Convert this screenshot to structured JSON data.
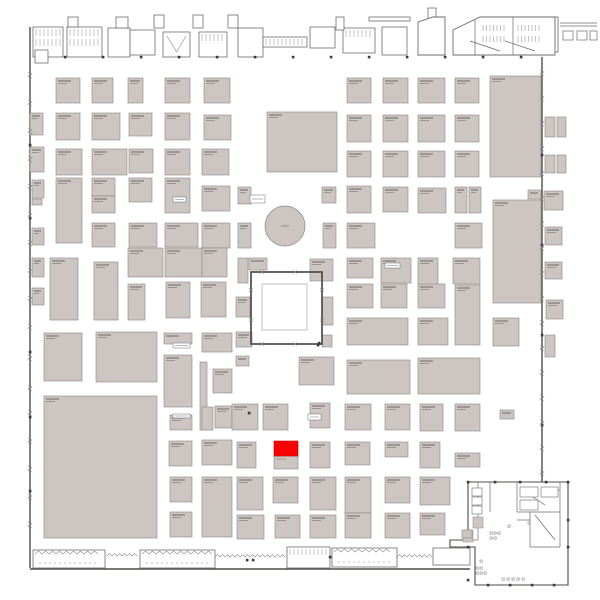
{
  "meta": {
    "title": "Exhibition hall floor plan",
    "canvas": {
      "w": 600,
      "h": 600,
      "bg": "#ffffff"
    }
  },
  "palette": {
    "booth_fill": "#ccc5c2",
    "booth_stroke": "#8d8682",
    "label_dark": "#564f4b",
    "label_light": "#7a736e",
    "wall": "#4f4a46",
    "structure": "#6b6b6b",
    "detail": "#888888",
    "column": "#3a3a3a",
    "highlight": "#fa0000",
    "courtyard_wall": "#4f4a46",
    "inner_square": "#9a9a9a",
    "white": "#ffffff"
  },
  "selected_booth": {
    "x": 274,
    "y": 441,
    "w": 24,
    "h": 15,
    "color": "#fa0000"
  },
  "selected_booth_base": {
    "x": 274,
    "y": 456,
    "w": 24,
    "h": 13
  },
  "circle": {
    "cx": 285,
    "cy": 226,
    "r": 20
  },
  "courtyard": {
    "outer": [
      251,
      272,
      71,
      72
    ],
    "inner": [
      262,
      284,
      45,
      46
    ]
  },
  "booths": [
    [
      56,
      78,
      24,
      25
    ],
    [
      92,
      78,
      21,
      25
    ],
    [
      128,
      78,
      15,
      25
    ],
    [
      165,
      78,
      25,
      25
    ],
    [
      204,
      78,
      26,
      25
    ],
    [
      30,
      113,
      13,
      22
    ],
    [
      56,
      113,
      24,
      27
    ],
    [
      92,
      113,
      28,
      27
    ],
    [
      129,
      113,
      23,
      23
    ],
    [
      165,
      113,
      25,
      27
    ],
    [
      204,
      115,
      27,
      25
    ],
    [
      30,
      147,
      14,
      25
    ],
    [
      56,
      149,
      26,
      26
    ],
    [
      92,
      149,
      35,
      26
    ],
    [
      129,
      149,
      24,
      24
    ],
    [
      165,
      149,
      25,
      26
    ],
    [
      202,
      149,
      27,
      26
    ],
    [
      32,
      180,
      12,
      18
    ],
    [
      32,
      199,
      10,
      6
    ],
    [
      56,
      178,
      26,
      65
    ],
    [
      92,
      178,
      23,
      18
    ],
    [
      92,
      196,
      23,
      17
    ],
    [
      129,
      178,
      23,
      24
    ],
    [
      165,
      178,
      25,
      35
    ],
    [
      202,
      186,
      28,
      25
    ],
    [
      32,
      228,
      12,
      17
    ],
    [
      92,
      223,
      23,
      24
    ],
    [
      129,
      223,
      28,
      24
    ],
    [
      165,
      223,
      33,
      24
    ],
    [
      202,
      223,
      28,
      25
    ],
    [
      32,
      258,
      12,
      19
    ],
    [
      32,
      288,
      12,
      17
    ],
    [
      50,
      258,
      28,
      62
    ],
    [
      94,
      262,
      24,
      58
    ],
    [
      128,
      248,
      35,
      29
    ],
    [
      165,
      248,
      37,
      29
    ],
    [
      202,
      248,
      25,
      29
    ],
    [
      128,
      284,
      17,
      36
    ],
    [
      166,
      282,
      24,
      36
    ],
    [
      201,
      282,
      25,
      35
    ],
    [
      267,
      112,
      70,
      60
    ],
    [
      238,
      187,
      13,
      17
    ],
    [
      238,
      223,
      13,
      25
    ],
    [
      322,
      187,
      14,
      16
    ],
    [
      323,
      223,
      13,
      25
    ],
    [
      347,
      186,
      24,
      27
    ],
    [
      347,
      223,
      28,
      25
    ],
    [
      347,
      78,
      24,
      25
    ],
    [
      383,
      78,
      25,
      25
    ],
    [
      418,
      78,
      27,
      25
    ],
    [
      455,
      78,
      24,
      25
    ],
    [
      490,
      76,
      51,
      101
    ],
    [
      347,
      115,
      24,
      27
    ],
    [
      383,
      115,
      25,
      27
    ],
    [
      418,
      115,
      27,
      27
    ],
    [
      455,
      115,
      24,
      27
    ],
    [
      347,
      151,
      24,
      26
    ],
    [
      383,
      151,
      25,
      26
    ],
    [
      418,
      151,
      27,
      26
    ],
    [
      455,
      151,
      24,
      26
    ],
    [
      383,
      187,
      25,
      25
    ],
    [
      418,
      188,
      28,
      25
    ],
    [
      455,
      187,
      12,
      26
    ],
    [
      469,
      187,
      12,
      26
    ],
    [
      528,
      190,
      13,
      9
    ],
    [
      455,
      223,
      27,
      25
    ],
    [
      493,
      200,
      48,
      103
    ],
    [
      347,
      258,
      26,
      20
    ],
    [
      381,
      258,
      30,
      25
    ],
    [
      418,
      258,
      20,
      27
    ],
    [
      453,
      258,
      27,
      26
    ],
    [
      347,
      284,
      26,
      24
    ],
    [
      381,
      284,
      26,
      24
    ],
    [
      418,
      284,
      27,
      24
    ],
    [
      455,
      285,
      25,
      60
    ],
    [
      545,
      117,
      10,
      20
    ],
    [
      557,
      117,
      9,
      20
    ],
    [
      545,
      155,
      10,
      18
    ],
    [
      557,
      155,
      9,
      18
    ],
    [
      544,
      191,
      19,
      19
    ],
    [
      545,
      227,
      17,
      18
    ],
    [
      545,
      262,
      17,
      17
    ],
    [
      546,
      300,
      17,
      19
    ],
    [
      545,
      335,
      10,
      22
    ],
    [
      238,
      258,
      10,
      25
    ],
    [
      249,
      258,
      18,
      12
    ],
    [
      310,
      259,
      23,
      22
    ],
    [
      236,
      297,
      14,
      20
    ],
    [
      236,
      332,
      16,
      15
    ],
    [
      322,
      297,
      11,
      28
    ],
    [
      322,
      335,
      10,
      12
    ],
    [
      236,
      356,
      13,
      10
    ],
    [
      299,
      357,
      35,
      28
    ],
    [
      347,
      318,
      61,
      27
    ],
    [
      418,
      318,
      30,
      27
    ],
    [
      493,
      318,
      26,
      28
    ],
    [
      347,
      360,
      63,
      34
    ],
    [
      418,
      358,
      62,
      36
    ],
    [
      44,
      333,
      38,
      48
    ],
    [
      96,
      332,
      61,
      50
    ],
    [
      44,
      396,
      113,
      142
    ],
    [
      164,
      333,
      28,
      11
    ],
    [
      202,
      333,
      30,
      19
    ],
    [
      164,
      355,
      28,
      52
    ],
    [
      200,
      362,
      7,
      68
    ],
    [
      213,
      369,
      19,
      24
    ],
    [
      202,
      407,
      11,
      23
    ],
    [
      215,
      406,
      17,
      22
    ],
    [
      170,
      415,
      22,
      15
    ],
    [
      169,
      441,
      23,
      25
    ],
    [
      202,
      440,
      30,
      25
    ],
    [
      170,
      477,
      22,
      25
    ],
    [
      202,
      477,
      30,
      60
    ],
    [
      170,
      512,
      22,
      25
    ],
    [
      232,
      404,
      26,
      26
    ],
    [
      263,
      404,
      25,
      26
    ],
    [
      237,
      442,
      19,
      26
    ],
    [
      237,
      477,
      26,
      33
    ],
    [
      273,
      477,
      25,
      26
    ],
    [
      237,
      515,
      27,
      24
    ],
    [
      275,
      515,
      25,
      23
    ],
    [
      310,
      403,
      20,
      25
    ],
    [
      345,
      404,
      26,
      26
    ],
    [
      385,
      404,
      25,
      26
    ],
    [
      420,
      404,
      23,
      27
    ],
    [
      455,
      404,
      25,
      27
    ],
    [
      500,
      410,
      14,
      9
    ],
    [
      310,
      442,
      20,
      26
    ],
    [
      345,
      442,
      25,
      23
    ],
    [
      385,
      442,
      23,
      15
    ],
    [
      420,
      442,
      20,
      26
    ],
    [
      455,
      453,
      25,
      14
    ],
    [
      310,
      477,
      26,
      33
    ],
    [
      345,
      477,
      26,
      36
    ],
    [
      385,
      477,
      25,
      26
    ],
    [
      420,
      477,
      30,
      28
    ],
    [
      310,
      515,
      26,
      23
    ],
    [
      345,
      513,
      26,
      25
    ],
    [
      385,
      513,
      25,
      25
    ],
    [
      420,
      513,
      25,
      22
    ],
    [
      462,
      530,
      10,
      8
    ]
  ],
  "label_boxes": [
    [
      250,
      195,
      15,
      8
    ],
    [
      173,
      343,
      17,
      5
    ],
    [
      308,
      414,
      13,
      6
    ],
    [
      173,
      414,
      17,
      4
    ],
    [
      385,
      263,
      15,
      5
    ],
    [
      173,
      197,
      13,
      5
    ]
  ],
  "rooms": [
    {
      "r": [
        33,
        27,
        30,
        30
      ],
      "d": "stalls2"
    },
    {
      "r": [
        35,
        50,
        13,
        13
      ],
      "d": "plain"
    },
    {
      "r": [
        67,
        27,
        35,
        30
      ],
      "d": "stalls2"
    },
    {
      "r": [
        108,
        28,
        22,
        29
      ],
      "d": "plain"
    },
    {
      "r": [
        130,
        30,
        25,
        25
      ],
      "d": "plain"
    },
    {
      "r": [
        163,
        32,
        27,
        25
      ],
      "d": "vee"
    },
    {
      "r": [
        199,
        32,
        28,
        25
      ],
      "d": "stalls"
    },
    {
      "r": [
        238,
        28,
        25,
        29
      ],
      "d": "plain"
    },
    {
      "r": [
        263,
        37,
        44,
        10
      ],
      "d": "comb"
    },
    {
      "r": [
        310,
        27,
        25,
        21
      ],
      "d": "plain"
    },
    {
      "r": [
        343,
        28,
        32,
        25
      ],
      "d": "stalls"
    },
    {
      "r": [
        382,
        27,
        25,
        28
      ],
      "d": "plain"
    }
  ],
  "towers": [
    [
      68,
      17,
      10,
      10
    ],
    [
      116,
      17,
      12,
      11
    ],
    [
      154,
      15,
      10,
      13
    ],
    [
      193,
      15,
      10,
      13
    ],
    [
      228,
      15,
      10,
      13
    ],
    [
      336,
      17,
      8,
      13
    ],
    [
      428,
      8,
      8,
      12
    ]
  ],
  "bars": [
    [
      369,
      17,
      41,
      4
    ],
    [
      552,
      17,
      6,
      35
    ]
  ],
  "trapezoid": [
    [
      418,
      55
    ],
    [
      418,
      22
    ],
    [
      433,
      17
    ],
    [
      445,
      17
    ],
    [
      445,
      55
    ]
  ],
  "top_complex": {
    "poly": [
      [
        453,
        55
      ],
      [
        453,
        30
      ],
      [
        480,
        17
      ],
      [
        555,
        17
      ],
      [
        555,
        55
      ]
    ],
    "combs": [
      [
        483,
        25,
        24
      ],
      [
        518,
        25,
        22
      ],
      [
        483,
        36,
        24
      ],
      [
        518,
        36,
        22
      ]
    ],
    "lines": [
      [
        475,
        20,
        475,
        55
      ],
      [
        513,
        17,
        513,
        55
      ],
      [
        470,
        41,
        500,
        51
      ],
      [
        505,
        41,
        535,
        51
      ],
      [
        453,
        55,
        555,
        55
      ]
    ]
  },
  "canopy": {
    "lines": [
      [
        560,
        23,
        597,
        23
      ],
      [
        560,
        26,
        597,
        26
      ]
    ],
    "boxes": [
      [
        563,
        31,
        10,
        9
      ],
      [
        577,
        31,
        10,
        9
      ],
      [
        590,
        31,
        7,
        9
      ]
    ]
  },
  "bottom_rooms": [
    {
      "r": [
        33,
        550,
        72,
        18
      ],
      "d": "saw"
    },
    {
      "r": [
        140,
        550,
        75,
        18
      ],
      "d": "saw"
    },
    {
      "r": [
        287,
        547,
        43,
        21
      ],
      "d": "comb"
    },
    {
      "r": [
        332,
        548,
        65,
        19
      ],
      "d": "saw"
    },
    {
      "r": [
        433,
        548,
        37,
        17
      ],
      "d": "plain"
    }
  ],
  "zigzag_walls": [
    [
      107,
      556,
      140,
      556
    ],
    [
      215,
      557,
      287,
      557
    ],
    [
      397,
      557,
      433,
      557
    ]
  ],
  "walls": [
    [
      30,
      27,
      30,
      568
    ],
    [
      542,
      57,
      542,
      482
    ],
    [
      30,
      569,
      470,
      569
    ]
  ],
  "entrance": {
    "outline": [
      [
        468,
        482
      ],
      [
        568,
        482
      ],
      [
        568,
        585
      ],
      [
        475,
        585
      ],
      [
        475,
        547
      ],
      [
        450,
        547
      ],
      [
        450,
        540
      ],
      [
        468,
        540
      ],
      [
        468,
        482
      ]
    ],
    "lines": [
      [
        478,
        482,
        478,
        540
      ],
      [
        468,
        540,
        478,
        540
      ],
      [
        517,
        482,
        517,
        512
      ],
      [
        517,
        512,
        560,
        512
      ],
      [
        560,
        482,
        560,
        512
      ],
      [
        530,
        512,
        530,
        547
      ],
      [
        530,
        547,
        560,
        547
      ],
      [
        560,
        512,
        560,
        547
      ],
      [
        517,
        520,
        530,
        520
      ],
      [
        535,
        515,
        555,
        540
      ],
      [
        490,
        482,
        490,
        512
      ],
      [
        545,
        490,
        560,
        490
      ],
      [
        530,
        495,
        545,
        505
      ]
    ],
    "rooms": [
      [
        472,
        488,
        10,
        8
      ],
      [
        472,
        497,
        10,
        8
      ],
      [
        472,
        506,
        10,
        8
      ],
      [
        520,
        487,
        18,
        10
      ],
      [
        541,
        487,
        17,
        10
      ],
      [
        520,
        500,
        18,
        10
      ]
    ],
    "gray": [
      [
        463,
        530,
        10,
        12
      ],
      [
        473,
        517,
        10,
        11
      ]
    ],
    "dots": [
      [
        490,
        532
      ],
      [
        494,
        532
      ],
      [
        498,
        532
      ],
      [
        490,
        537
      ],
      [
        494,
        537
      ],
      [
        476,
        567
      ],
      [
        480,
        567
      ],
      [
        476,
        572
      ],
      [
        480,
        572
      ],
      [
        484,
        572
      ],
      [
        502,
        578
      ],
      [
        507,
        578
      ],
      [
        512,
        578
      ],
      [
        517,
        578
      ],
      [
        522,
        578
      ],
      [
        480,
        560
      ],
      [
        528,
        522
      ],
      [
        508,
        525
      ]
    ]
  },
  "columns": [
    [
      65,
      57
    ],
    [
      103,
      57
    ],
    [
      141,
      57
    ],
    [
      179,
      57
    ],
    [
      217,
      57
    ],
    [
      255,
      57
    ],
    [
      293,
      57
    ],
    [
      331,
      57
    ],
    [
      369,
      57
    ],
    [
      407,
      57
    ],
    [
      445,
      57
    ],
    [
      483,
      57
    ],
    [
      521,
      57
    ],
    [
      30,
      145
    ],
    [
      30,
      218
    ],
    [
      30,
      352
    ],
    [
      30,
      417
    ],
    [
      30,
      491
    ],
    [
      542,
      155
    ],
    [
      542,
      245
    ],
    [
      542,
      335
    ],
    [
      542,
      425
    ],
    [
      249,
      413
    ],
    [
      318,
      345
    ],
    [
      319,
      343
    ],
    [
      247,
      560
    ],
    [
      253,
      560
    ],
    [
      330,
      557
    ],
    [
      468,
      482
    ],
    [
      495,
      482
    ],
    [
      520,
      482
    ],
    [
      546,
      482
    ],
    [
      568,
      482
    ],
    [
      468,
      547
    ],
    [
      468,
      580
    ],
    [
      488,
      585
    ],
    [
      510,
      585
    ],
    [
      532,
      585
    ],
    [
      554,
      585
    ],
    [
      568,
      520
    ],
    [
      568,
      547
    ]
  ],
  "doors": {
    "left_x": 30,
    "left_ys": [
      72,
      100,
      128,
      156,
      184,
      212,
      240,
      268,
      296,
      324,
      355,
      385,
      410,
      438,
      466,
      494,
      522
    ],
    "right_x": 542,
    "right_ys": [
      70,
      95,
      120,
      145,
      170,
      195,
      220,
      245,
      270,
      295,
      320,
      345,
      370,
      395,
      420,
      445,
      470
    ]
  },
  "courtyard_doors": [
    [
      262,
      272
    ],
    [
      295,
      272
    ],
    [
      251,
      290
    ],
    [
      251,
      320
    ],
    [
      322,
      290
    ],
    [
      322,
      320
    ],
    [
      262,
      344
    ],
    [
      295,
      344
    ]
  ]
}
